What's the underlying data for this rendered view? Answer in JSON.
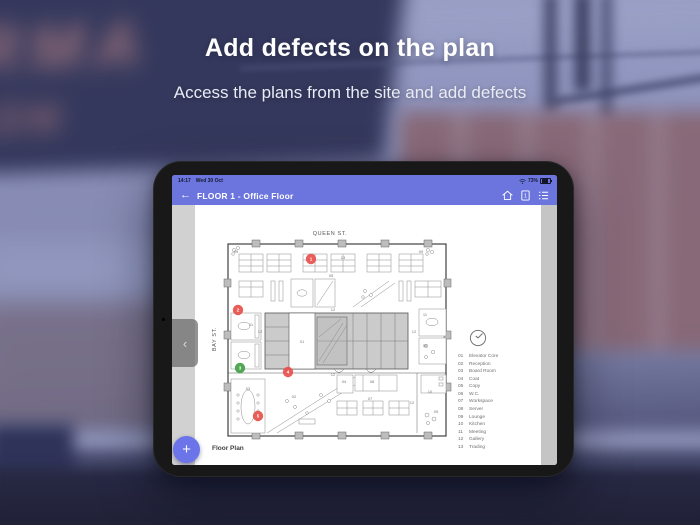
{
  "hero": {
    "title": "Add defects on the plan",
    "subtitle": "Access the plans from the site and add defects"
  },
  "background": {
    "graffiti_line1": "RMA",
    "graffiti_line2": "ON"
  },
  "tablet": {
    "colors": {
      "header": "#6b75dd",
      "fab": "#6b74e8",
      "marker_red": "#e8504b",
      "marker_green": "#43a047"
    },
    "status_bar": {
      "time": "14:17",
      "date": "Wed 30 Oct",
      "battery": "73%"
    },
    "nav_bar": {
      "back_icon": "←",
      "title": "FLOOR 1 - Office Floor",
      "doc_badge": "1"
    },
    "drawer_chevron": "‹",
    "fab_label": "+",
    "caption": "Floor Plan",
    "plan": {
      "street_top": "QUEEN ST.",
      "street_left": "BAY ST.",
      "room_labels": [
        {
          "text": "09",
          "x": 33,
          "y": 28
        },
        {
          "text": "13",
          "x": 140,
          "y": 34
        },
        {
          "text": "09",
          "x": 218,
          "y": 28
        },
        {
          "text": "05",
          "x": 128,
          "y": 52
        },
        {
          "text": "12",
          "x": 130,
          "y": 86
        },
        {
          "text": "12",
          "x": 57,
          "y": 108
        },
        {
          "text": "12",
          "x": 211,
          "y": 108
        },
        {
          "text": "01",
          "x": 99,
          "y": 118
        },
        {
          "text": "11",
          "x": 48,
          "y": 101
        },
        {
          "text": "11",
          "x": 222,
          "y": 91
        },
        {
          "text": "06",
          "x": 222,
          "y": 122
        },
        {
          "text": "12",
          "x": 130,
          "y": 151
        },
        {
          "text": "02",
          "x": 91,
          "y": 173
        },
        {
          "text": "04",
          "x": 141,
          "y": 158
        },
        {
          "text": "08",
          "x": 169,
          "y": 158
        },
        {
          "text": "07",
          "x": 167,
          "y": 175
        },
        {
          "text": "12",
          "x": 209,
          "y": 179
        },
        {
          "text": "10",
          "x": 227,
          "y": 168
        },
        {
          "text": "09",
          "x": 233,
          "y": 188
        },
        {
          "text": "03",
          "x": 45,
          "y": 165
        }
      ],
      "legend": [
        {
          "num": "01",
          "name": "Elevator Core"
        },
        {
          "num": "02",
          "name": "Reception"
        },
        {
          "num": "03",
          "name": "Board Room"
        },
        {
          "num": "04",
          "name": "Coat"
        },
        {
          "num": "05",
          "name": "Copy"
        },
        {
          "num": "06",
          "name": "W.C."
        },
        {
          "num": "07",
          "name": "Workspace"
        },
        {
          "num": "08",
          "name": "Server"
        },
        {
          "num": "09",
          "name": "Lounge"
        },
        {
          "num": "10",
          "name": "Kitchen"
        },
        {
          "num": "11",
          "name": "Meeting"
        },
        {
          "num": "12",
          "name": "Gallery"
        },
        {
          "num": "13",
          "name": "Trading"
        }
      ],
      "markers": [
        {
          "n": "1",
          "x": 108,
          "y": 34,
          "status": "red"
        },
        {
          "n": "2",
          "x": 35,
          "y": 85,
          "status": "red"
        },
        {
          "n": "3",
          "x": 37,
          "y": 143,
          "status": "green"
        },
        {
          "n": "4",
          "x": 85,
          "y": 147,
          "status": "red"
        },
        {
          "n": "5",
          "x": 55,
          "y": 191,
          "status": "red"
        }
      ]
    }
  }
}
